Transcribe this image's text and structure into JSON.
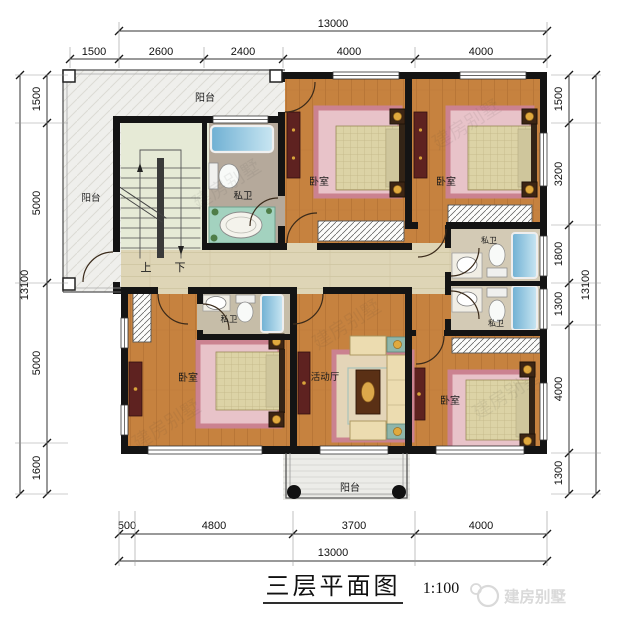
{
  "sheet": {
    "title": "三层平面图",
    "scale": "1:100"
  },
  "watermark": {
    "brand": "建房别墅"
  },
  "rooms": {
    "balcony_top": "阳台",
    "balcony_left": "阳台",
    "balcony_bottom": "阳台",
    "bedroom_tm": "卧室",
    "bedroom_tr": "卧室",
    "bedroom_bl": "卧室",
    "bedroom_br": "卧室",
    "bath_main": "私卫",
    "bath_r1": "私卫",
    "bath_r2": "私卫",
    "bath_bl": "私卫",
    "living": "活动厅",
    "stair_up": "上",
    "stair_down": "下"
  },
  "dims": {
    "top": {
      "total": "13000",
      "segments": [
        "1500",
        "2600",
        "2400",
        "4000",
        "4000"
      ]
    },
    "bottom": {
      "total": "13000",
      "segments": [
        "500",
        "4800",
        "3700",
        "4000"
      ]
    },
    "left": {
      "total": "13100",
      "segments": [
        "1500",
        "5000",
        "5000",
        "1600"
      ]
    },
    "right": {
      "total": "13100",
      "segments": [
        "1500",
        "3200",
        "1800",
        "1300",
        "4000",
        "1300"
      ]
    }
  },
  "colors": {
    "wood": "#c6823f",
    "corridor": "#ded5b6",
    "wall": "#141414",
    "bath_taupe": "#b5a99b",
    "bath_light": "#d3cab5",
    "balcony": "#efefec",
    "rug_pink": "#cb8290",
    "tub_blue": "#6fb0d3",
    "gold": "#e0a93e",
    "maroon": "#5e2220"
  }
}
